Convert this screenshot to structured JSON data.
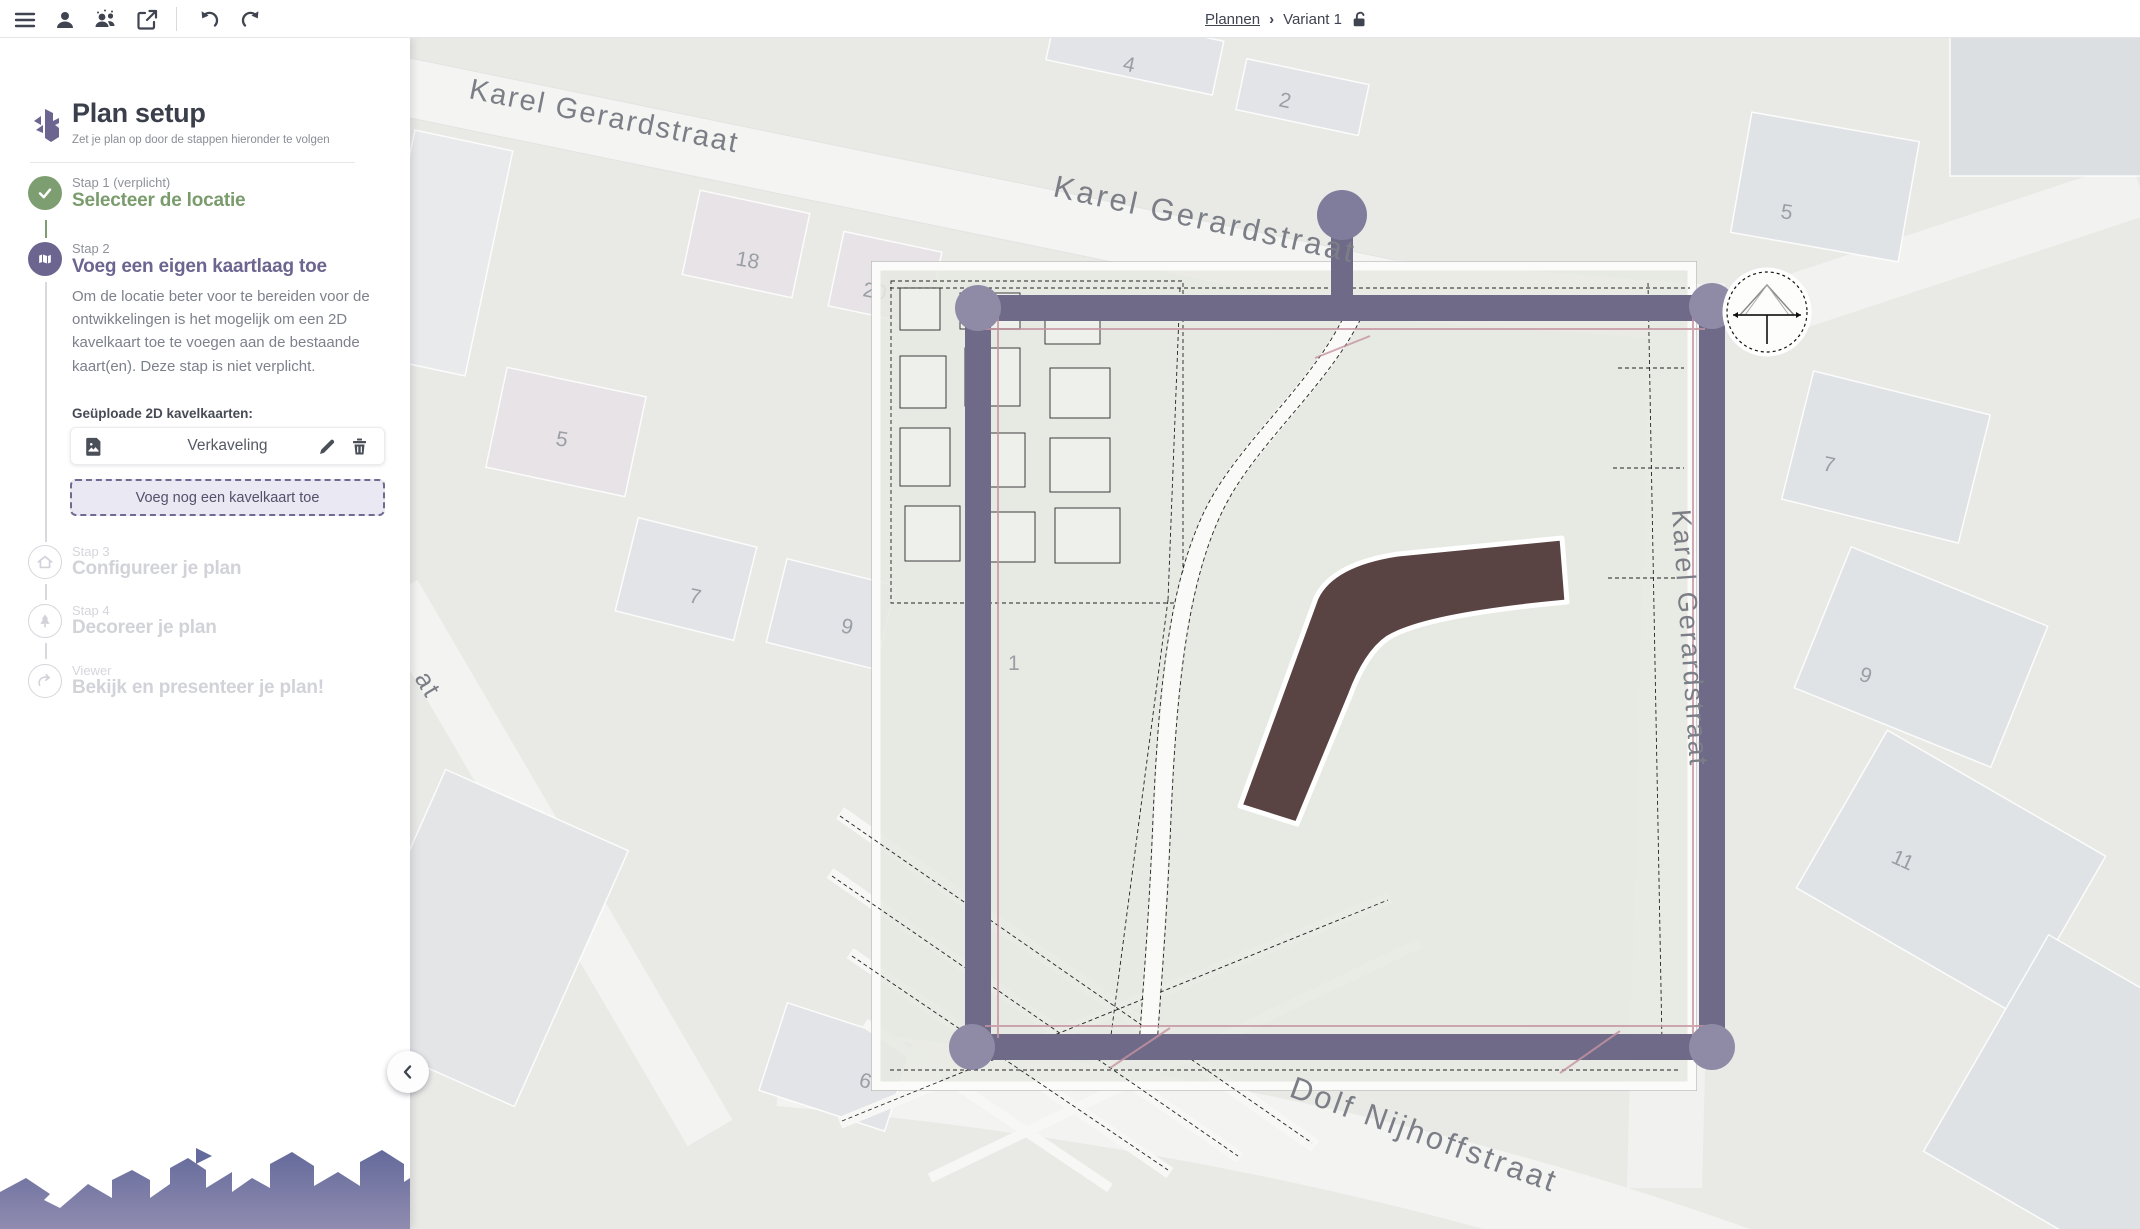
{
  "topbar": {
    "breadcrumb": {
      "root": "Plannen",
      "separator": "›",
      "current": "Variant 1"
    }
  },
  "sidebar": {
    "title": "Plan setup",
    "subtitle": "Zet je plan op door de stappen hieronder te volgen",
    "steps": [
      {
        "kicker": "Stap 1 (verplicht)",
        "title": "Selecteer de locatie"
      },
      {
        "kicker": "Stap 2",
        "title": "Voeg een eigen kaartlaag toe",
        "description": "Om de locatie beter voor te bereiden voor de ontwikkelingen is het mogelijk om een 2D kavelkaart toe te voegen aan de bestaande kaart(en). Deze stap is niet verplicht.",
        "uploads_label": "Geüploade 2D kavelkaarten:",
        "uploads": [
          {
            "name": "Verkaveling"
          }
        ],
        "add_button_label": "Voeg nog een kavelkaart toe"
      },
      {
        "kicker": "Stap 3",
        "title": "Configureer je plan"
      },
      {
        "kicker": "Stap 4",
        "title": "Decoreer je plan"
      },
      {
        "kicker": "Viewer",
        "title": "Bekijk en presenteer je plan!"
      }
    ]
  },
  "map": {
    "streets": [
      {
        "text": "Karel Gerardstraat"
      },
      {
        "text": "Karel Gerardstraat"
      },
      {
        "text": "Karel Gerardstraat"
      },
      {
        "text": "Dolf Nijhoffstraat"
      },
      {
        "text": "at"
      }
    ],
    "house_numbers": [
      "4",
      "2",
      "18",
      "20",
      "5",
      "7",
      "9",
      "1",
      "6",
      "5",
      "7",
      "9",
      "11"
    ]
  },
  "colors": {
    "accent_purple": "#6b6590",
    "step_green": "#7d9e70",
    "map_street_purple": "#6e6a88",
    "plan_road_brown": "#5a4343",
    "plan_accent_pink": "#c694a1"
  }
}
